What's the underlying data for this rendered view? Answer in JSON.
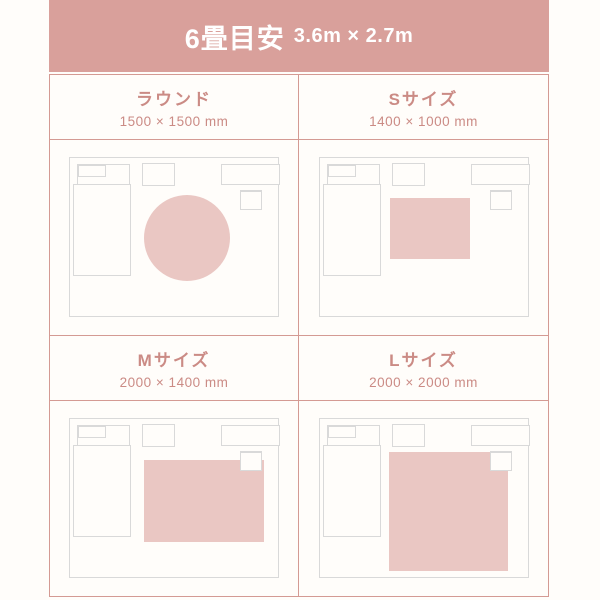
{
  "header": {
    "title": "6畳目安",
    "dimensions": "3.6m × 2.7m"
  },
  "sizes": [
    {
      "name": "ラウンド",
      "dimensions": "1500 × 1500 mm",
      "rug_shape": "circle"
    },
    {
      "name": "Sサイズ",
      "dimensions": "1400 × 1000 mm",
      "rug_shape": "rectangle"
    },
    {
      "name": "Mサイズ",
      "dimensions": "2000 × 1400 mm",
      "rug_shape": "rectangle"
    },
    {
      "name": "Lサイズ",
      "dimensions": "2000 × 2000 mm",
      "rug_shape": "square"
    }
  ],
  "colors": {
    "background": "#fffdfa",
    "header_band": "#d9a09b",
    "header_text": "#ffffff",
    "grid_line": "#d49a93",
    "label_text": "#cb8b85",
    "furniture_line": "#d9d9d9",
    "rug_fill": "#eac7c3"
  }
}
